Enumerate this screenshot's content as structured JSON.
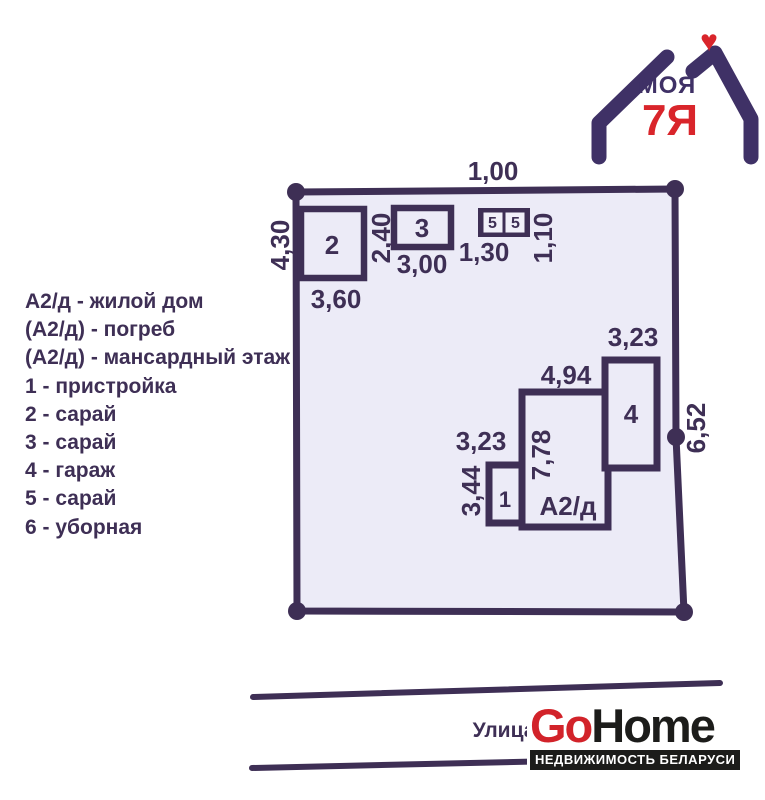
{
  "colors": {
    "plan_purple": "#3e2f55",
    "plot_fill": "#ecebf7",
    "cell_fill": "#f1f0f9",
    "logo_purple": "#3f3166",
    "logo_red": "#d9252b",
    "gohome_red": "#d2232a",
    "gohome_black": "#1c1c1a"
  },
  "legend": {
    "items": [
      "А2/д - жилой дом",
      "(А2/д) - погреб",
      "(А2/д) - мансардный этаж",
      "1 - пристройка",
      "2 - сарай",
      "3 - сарай",
      "4 - гараж",
      "5 - сарай",
      "6 - уборная"
    ]
  },
  "plan": {
    "dim_top": "1,00",
    "dim_left": "4,30",
    "dim_right": "6,52",
    "dim_shed2_w": "3,60",
    "dim_shed3_h": "2,40",
    "dim_shed3_w": "3,00",
    "dim_shed5_w": "1,30",
    "dim_shed5_h": "1,10",
    "dim_garage_w": "3,23",
    "dim_house_w": "4,94",
    "dim_house_h": "7,78",
    "dim_annex_w": "3,23",
    "dim_annex_h": "3,44",
    "label_house": "А2/д",
    "label_annex": "1",
    "label_shed2": "2",
    "label_shed3": "3",
    "label_shed5a": "5",
    "label_shed5b": "5",
    "label_garage": "4"
  },
  "street": {
    "label": "Улица"
  },
  "brand": {
    "top": "МОЯ",
    "main": "7Я",
    "heart": "♥"
  },
  "gohome": {
    "go": "Go",
    "home": "Home",
    "tagline": "НЕДВИЖИМОСТЬ БЕЛАРУСИ"
  }
}
